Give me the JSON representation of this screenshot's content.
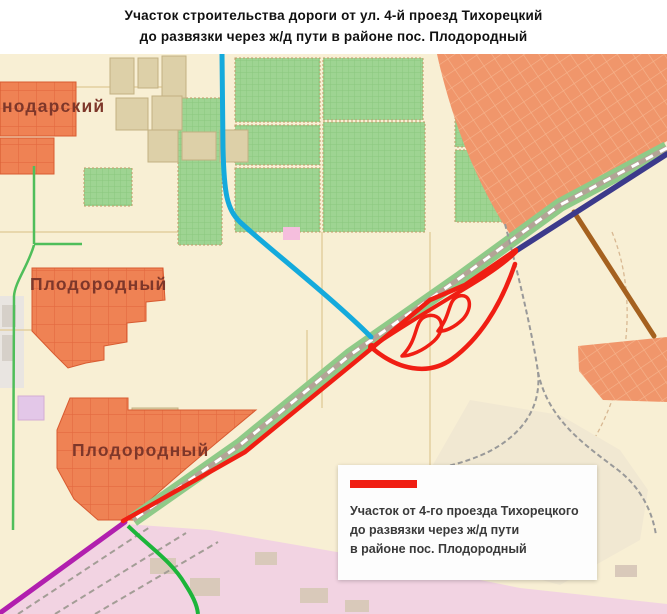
{
  "title": {
    "line1": "Участок строительства дороги от ул. 4-й проезд Тихорецкий",
    "line2": "до развязки через ж/д пути в районе пос. Плодородный"
  },
  "map_labels": {
    "district_partial": "нодарский",
    "settlement_1": "Плодородный",
    "settlement_2": "Плодородный"
  },
  "legend": {
    "item_line1": "Участок от 4-го проезда Тихорецкого",
    "item_line2": "до развязки через ж/д пути",
    "item_line3": "в районе пос. Плодородный",
    "swatch_color": "#f01e13"
  },
  "colors": {
    "highlight_road_red": "#f01e13",
    "road_blue": "#14aadc",
    "road_magenta": "#b11fae",
    "road_navy": "#3c3a8b",
    "road_green": "#1cb53a",
    "road_brown": "#a5611f",
    "railway_band_green": "#8fca88",
    "urban_area_orange": "#f0966b",
    "blocks_orange": "#ef8254",
    "garden_green": "#9ed492",
    "industrial_pink": "#f2d3e2",
    "map_base_cream": "#f8efd4"
  }
}
